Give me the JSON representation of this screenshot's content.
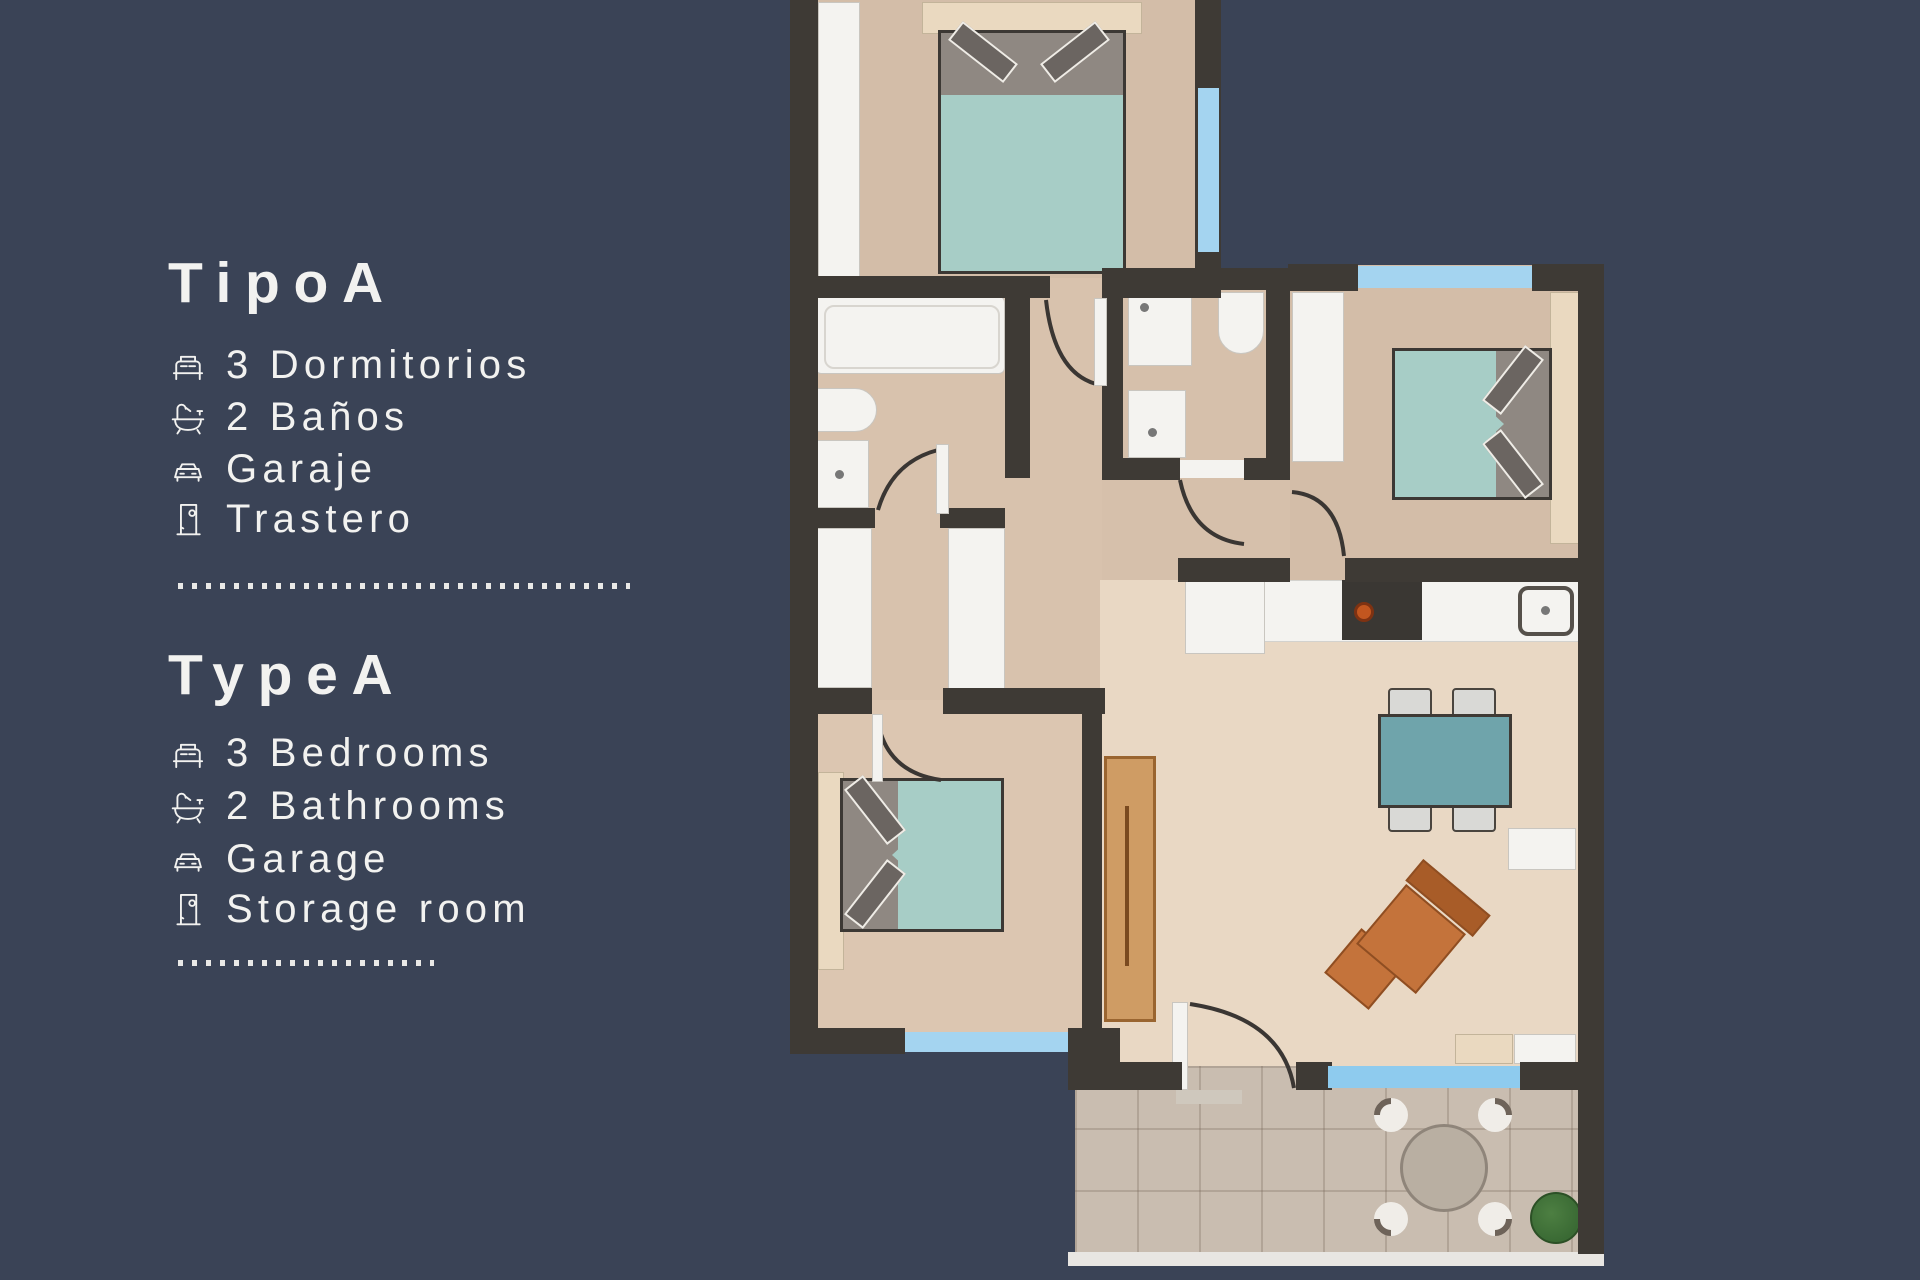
{
  "panel": {
    "sections": [
      {
        "title": "TipoA",
        "items": [
          {
            "icon": "bed-icon",
            "label": "3 Dormitorios"
          },
          {
            "icon": "bathtub-icon",
            "label": "2 Baños"
          },
          {
            "icon": "car-icon",
            "label": "Garaje"
          },
          {
            "icon": "door-icon",
            "label": "Trastero"
          }
        ]
      },
      {
        "title": "TypeA",
        "items": [
          {
            "icon": "bed-icon",
            "label": "3 Bedrooms"
          },
          {
            "icon": "bathtub-icon",
            "label": "2 Bathrooms"
          },
          {
            "icon": "car-icon",
            "label": "Garage"
          },
          {
            "icon": "door-icon",
            "label": "Storage room"
          }
        ]
      }
    ]
  },
  "floorplan": {
    "rooms": [
      "bedroom-1",
      "bathroom-1",
      "hallway",
      "bathroom-2",
      "bedroom-2",
      "kitchen-living-room",
      "bedroom-3",
      "terrace"
    ],
    "furniture": [
      "double-bed",
      "wardrobe",
      "bathtub",
      "toilet",
      "washbasin",
      "shower",
      "kitchen-counter",
      "stove",
      "kitchen-sink",
      "dining-table",
      "chairs",
      "armchair",
      "sideboard",
      "terrace-table",
      "plant"
    ]
  },
  "colors": {
    "background": "#3a4356",
    "text": "#f2f2f0",
    "walls": "#3e3a35",
    "floor": "#d8c2ad",
    "window": "#a4d4f0",
    "bed": "#a7cdc6",
    "dining_table": "#6fa4ab",
    "armchair": "#c4733b",
    "terrace_tile": "#c9bdb0"
  }
}
